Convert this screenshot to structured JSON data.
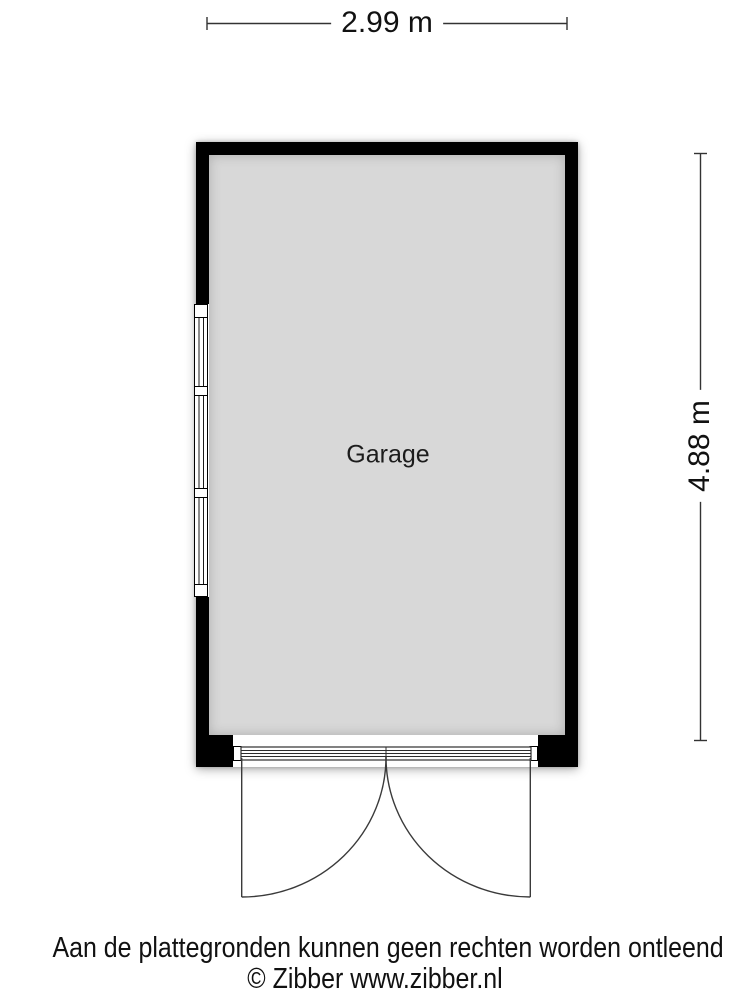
{
  "plan": {
    "room_label": "Garage",
    "dimensions": {
      "width_label": "2.99 m",
      "height_label": "4.88 m"
    },
    "symbols": {
      "window": "three-section-window-left-wall",
      "door": "double-outward-swing-garage-door-bottom"
    },
    "colors": {
      "wall": "#000000",
      "floor": "#d8d8d8",
      "line": "#333333",
      "background": "#ffffff"
    }
  },
  "footer": {
    "disclaimer": "Aan de plattegronden kunnen geen rechten worden ontleend",
    "copyright": "© Zibber www.zibber.nl"
  }
}
